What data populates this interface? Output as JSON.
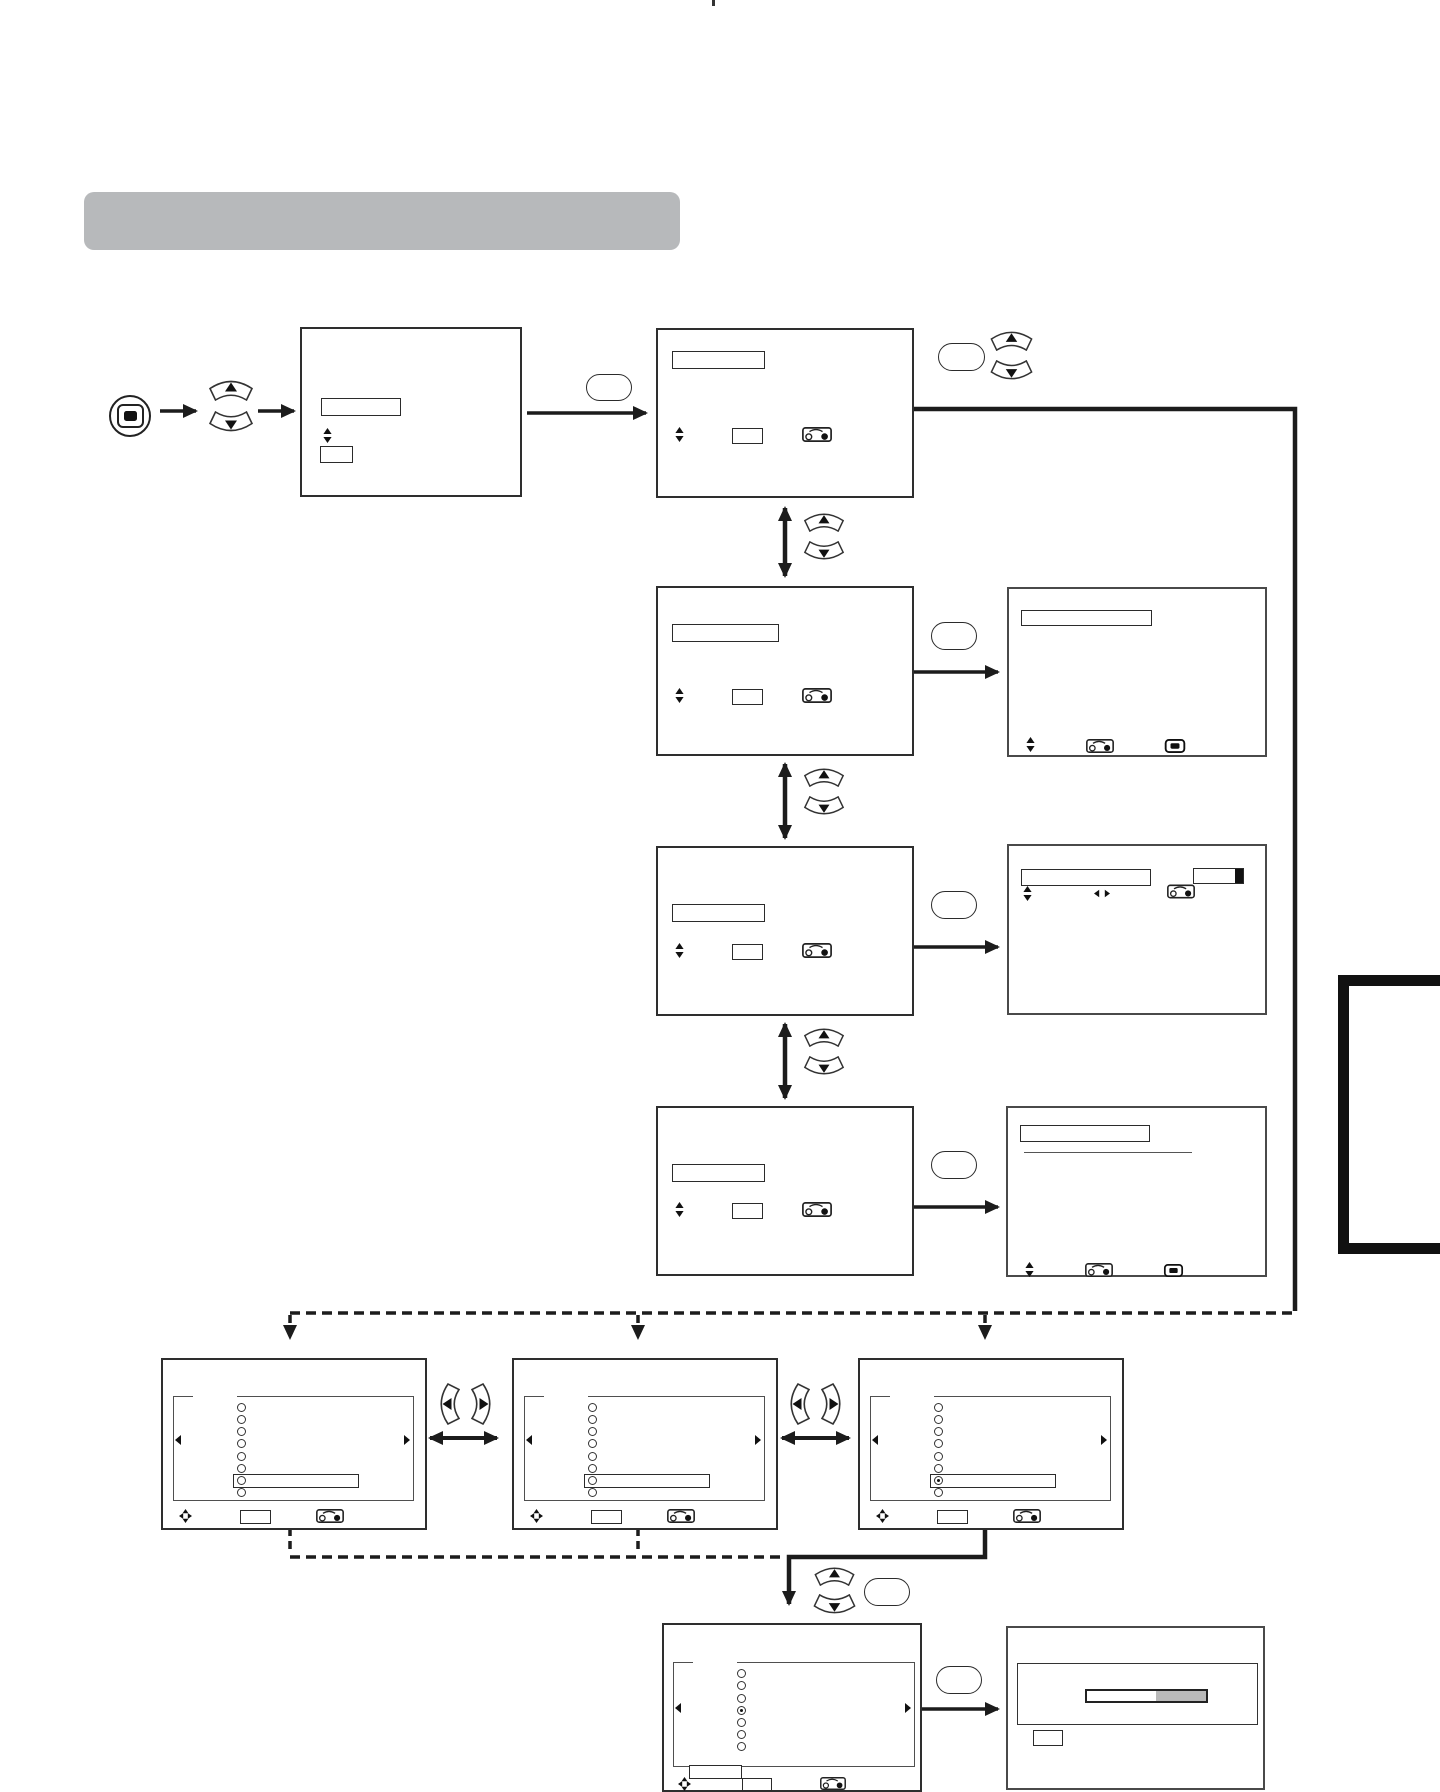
{
  "document": {
    "kind": "user-manual page",
    "content": "OSD menu navigation flowchart; all on-screen label fields are blank rectangles (no legible text on the page)",
    "title_bar": {
      "text": "",
      "style": "gray rounded bar, empty"
    },
    "side_tab": {
      "text": "",
      "style": "thick black outlined rectangle bleeding off right page edge"
    }
  },
  "colors": {
    "ink": "#1c1c1c",
    "box_border": "#2e2e2e",
    "screen_border": "#4a4a4a",
    "title_bar_gray": "#b7b9bb",
    "meter_gray": "#b9b9b9",
    "icon_black": "#111111",
    "page_background": "#ffffff"
  },
  "icons": [
    "menu-button-icon",
    "up-fan-button-icon",
    "down-fan-button-icon",
    "left-fan-button-icon",
    "right-fan-button-icon",
    "ok-pill-button-icon",
    "jog-dial-icon",
    "menu-glyph-icon",
    "four-way-pad-icon",
    "mini-up-down-icon",
    "left-right-pair-icon",
    "radio-option-icon",
    "left-triangle-icon",
    "right-triangle-icon"
  ],
  "flow": {
    "entry": [
      "menu-button",
      "up-down-keys",
      "osd-root-screen"
    ],
    "menu_column": [
      "menu-screen-1",
      "menu-screen-2",
      "menu-screen-3",
      "menu-screen-4"
    ],
    "result_screens": [
      "result-screen-2",
      "result-screen-3 (meter bar)",
      "result-screen-4 (underline)"
    ],
    "bottom_row": [
      "option-screen-a",
      "option-screen-b",
      "option-screen-c"
    ],
    "final": [
      "option-screen-d",
      "progress-screen (bar 58% gray)"
    ],
    "connectors": [
      "solid thick arrows",
      "double-headed arrows",
      "dashed alternate paths"
    ]
  },
  "progress_bar": {
    "filled_fraction_gray": 0.42
  }
}
